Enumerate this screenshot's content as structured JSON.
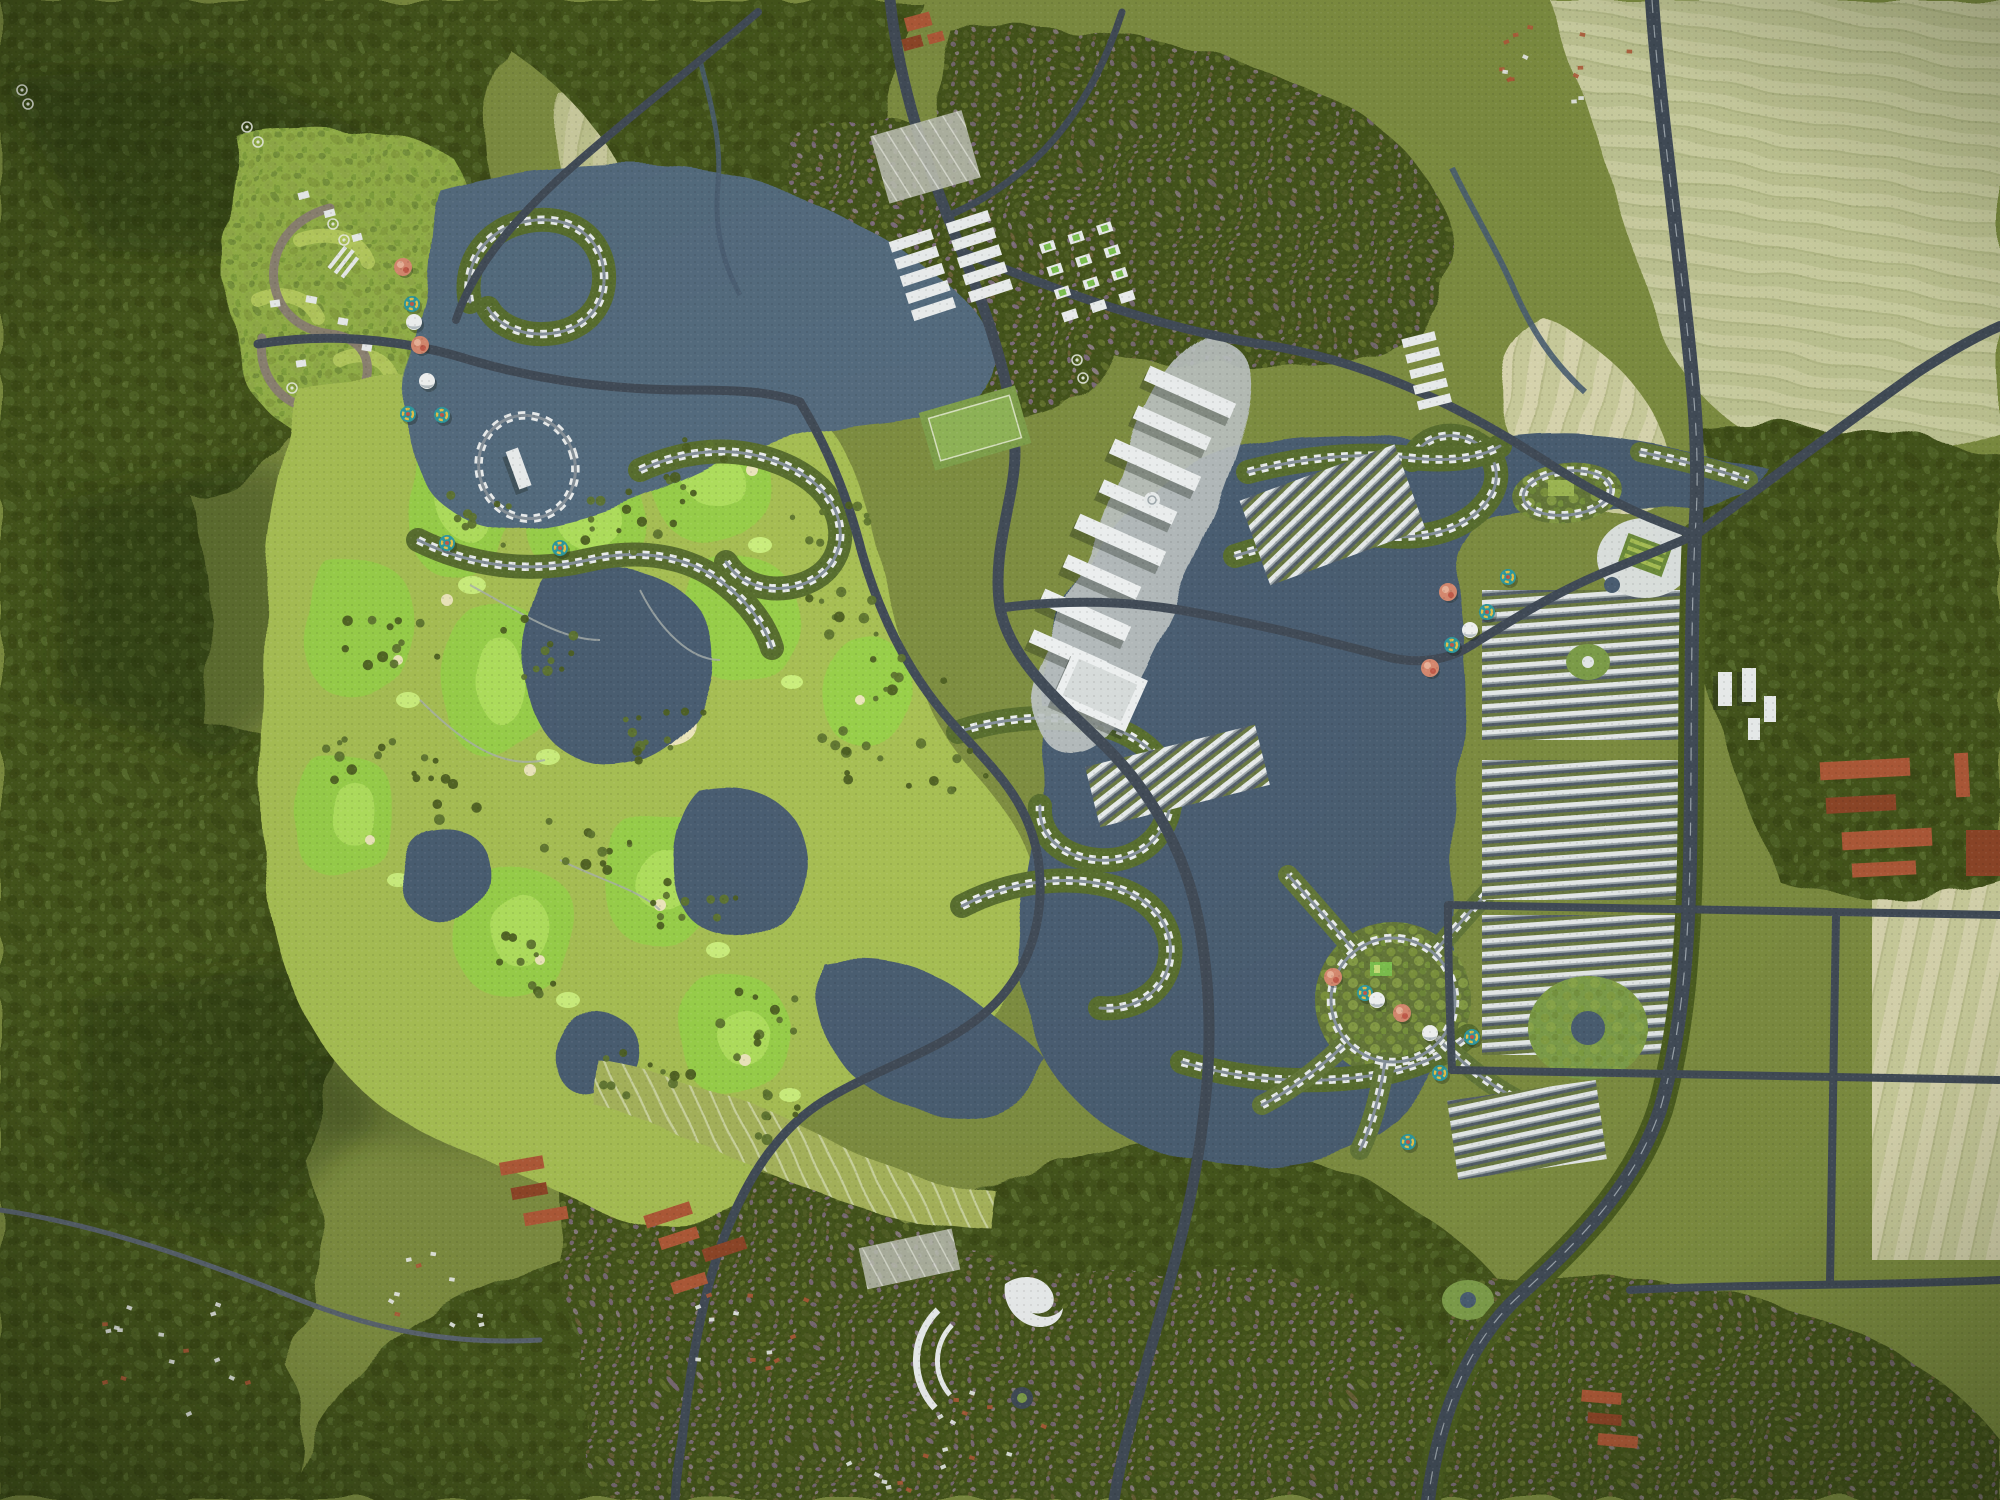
{
  "meta": {
    "kind": "aerial-3d-masterplan-rendering",
    "scene": {
      "width": 2000,
      "height": 1500
    }
  },
  "palette": {
    "terrain_base": "#7f8f42",
    "forest_dark": "#45541f",
    "forest_deep": "#2e3a13",
    "canopy_light": "#8caa44",
    "hill_green": "#95b24a",
    "golf_rough": "#a9c155",
    "fairway": "#9ad14b",
    "fairway_light": "#b5e463",
    "green_light": "#cdf07e",
    "bunker_sand": "#eee8bd",
    "water": "#4b5f73",
    "water_marina": "#566d80",
    "water_edge": "#8aa0ae",
    "road": "#424c58",
    "road_minor": "#5b6570",
    "road_line": "#cdd5da",
    "boulevard_trees": "#4c5e20",
    "building_white": "#edf0f0",
    "plaza": "#bcc3c2",
    "roof_red": "#b05a38",
    "roof_red_dark": "#8f4628",
    "field_tan": "#cccfa0",
    "field_pale": "#dcd9b2",
    "field_green": "#b9c78d",
    "village_purple": "#8d7394",
    "trail": "#8d8276",
    "park_green": "#7fa04b",
    "balloon_salmon": "#d88a70",
    "balloon_red": "#c25b4a",
    "balloon_teal": "#2f9aa0",
    "balloon_yellow": "#e8c34a",
    "dome_white": "#f3f5f4"
  },
  "balloons": [
    {
      "x": 403,
      "y": 267,
      "kind": "salmon"
    },
    {
      "x": 412,
      "y": 304,
      "kind": "rainbow"
    },
    {
      "x": 414,
      "y": 322,
      "kind": "dome"
    },
    {
      "x": 420,
      "y": 345,
      "kind": "salmon"
    },
    {
      "x": 427,
      "y": 381,
      "kind": "dome"
    },
    {
      "x": 408,
      "y": 414,
      "kind": "rainbow"
    },
    {
      "x": 442,
      "y": 415,
      "kind": "rainbow"
    },
    {
      "x": 447,
      "y": 543,
      "kind": "rainbow"
    },
    {
      "x": 560,
      "y": 548,
      "kind": "rainbow"
    },
    {
      "x": 1448,
      "y": 592,
      "kind": "salmon"
    },
    {
      "x": 1487,
      "y": 612,
      "kind": "rainbow"
    },
    {
      "x": 1470,
      "y": 630,
      "kind": "dome"
    },
    {
      "x": 1452,
      "y": 645,
      "kind": "rainbow"
    },
    {
      "x": 1430,
      "y": 668,
      "kind": "salmon"
    },
    {
      "x": 1508,
      "y": 577,
      "kind": "rainbow"
    },
    {
      "x": 1333,
      "y": 977,
      "kind": "salmon"
    },
    {
      "x": 1365,
      "y": 993,
      "kind": "rainbow"
    },
    {
      "x": 1377,
      "y": 1000,
      "kind": "dome"
    },
    {
      "x": 1402,
      "y": 1013,
      "kind": "salmon"
    },
    {
      "x": 1430,
      "y": 1033,
      "kind": "dome"
    },
    {
      "x": 1472,
      "y": 1037,
      "kind": "rainbow"
    },
    {
      "x": 1440,
      "y": 1073,
      "kind": "rainbow"
    },
    {
      "x": 1408,
      "y": 1142,
      "kind": "rainbow"
    }
  ],
  "decor": {
    "rings": [
      [
        22,
        90
      ],
      [
        28,
        104
      ],
      [
        247,
        127
      ],
      [
        258,
        142
      ],
      [
        333,
        224
      ],
      [
        344,
        240
      ],
      [
        292,
        388
      ],
      [
        1077,
        360
      ],
      [
        1083,
        378
      ]
    ],
    "tree_clusters": [
      [
        620,
        520,
        55,
        38,
        12,
        11
      ],
      [
        700,
        470,
        50,
        34,
        10,
        21
      ],
      [
        470,
        520,
        48,
        36,
        10,
        31
      ],
      [
        390,
        640,
        52,
        40,
        12,
        41
      ],
      [
        545,
        645,
        50,
        36,
        11,
        51
      ],
      [
        660,
        725,
        55,
        40,
        12,
        61
      ],
      [
        585,
        845,
        52,
        40,
        12,
        71
      ],
      [
        700,
        905,
        50,
        36,
        11,
        81
      ],
      [
        445,
        785,
        48,
        36,
        10,
        91
      ],
      [
        360,
        765,
        46,
        34,
        9,
        101
      ],
      [
        760,
        1025,
        52,
        38,
        11,
        111
      ],
      [
        520,
        965,
        50,
        36,
        10,
        121
      ],
      [
        645,
        1065,
        50,
        36,
        10,
        131
      ],
      [
        845,
        615,
        44,
        32,
        9,
        141
      ],
      [
        855,
        755,
        46,
        34,
        9,
        151
      ],
      [
        905,
        680,
        44,
        32,
        8,
        161
      ],
      [
        945,
        770,
        44,
        32,
        8,
        171
      ],
      [
        830,
        520,
        40,
        30,
        8,
        181
      ],
      [
        760,
        1110,
        46,
        30,
        8,
        191
      ]
    ],
    "house_specks": [
      [
        160,
        1350,
        95,
        70,
        16,
        7
      ],
      [
        420,
        1300,
        70,
        50,
        10,
        17
      ],
      [
        760,
        1330,
        75,
        55,
        12,
        27
      ],
      [
        980,
        1420,
        65,
        45,
        10,
        37
      ],
      [
        1560,
        60,
        70,
        45,
        14,
        47
      ],
      [
        890,
        1460,
        55,
        35,
        8,
        57
      ]
    ]
  }
}
